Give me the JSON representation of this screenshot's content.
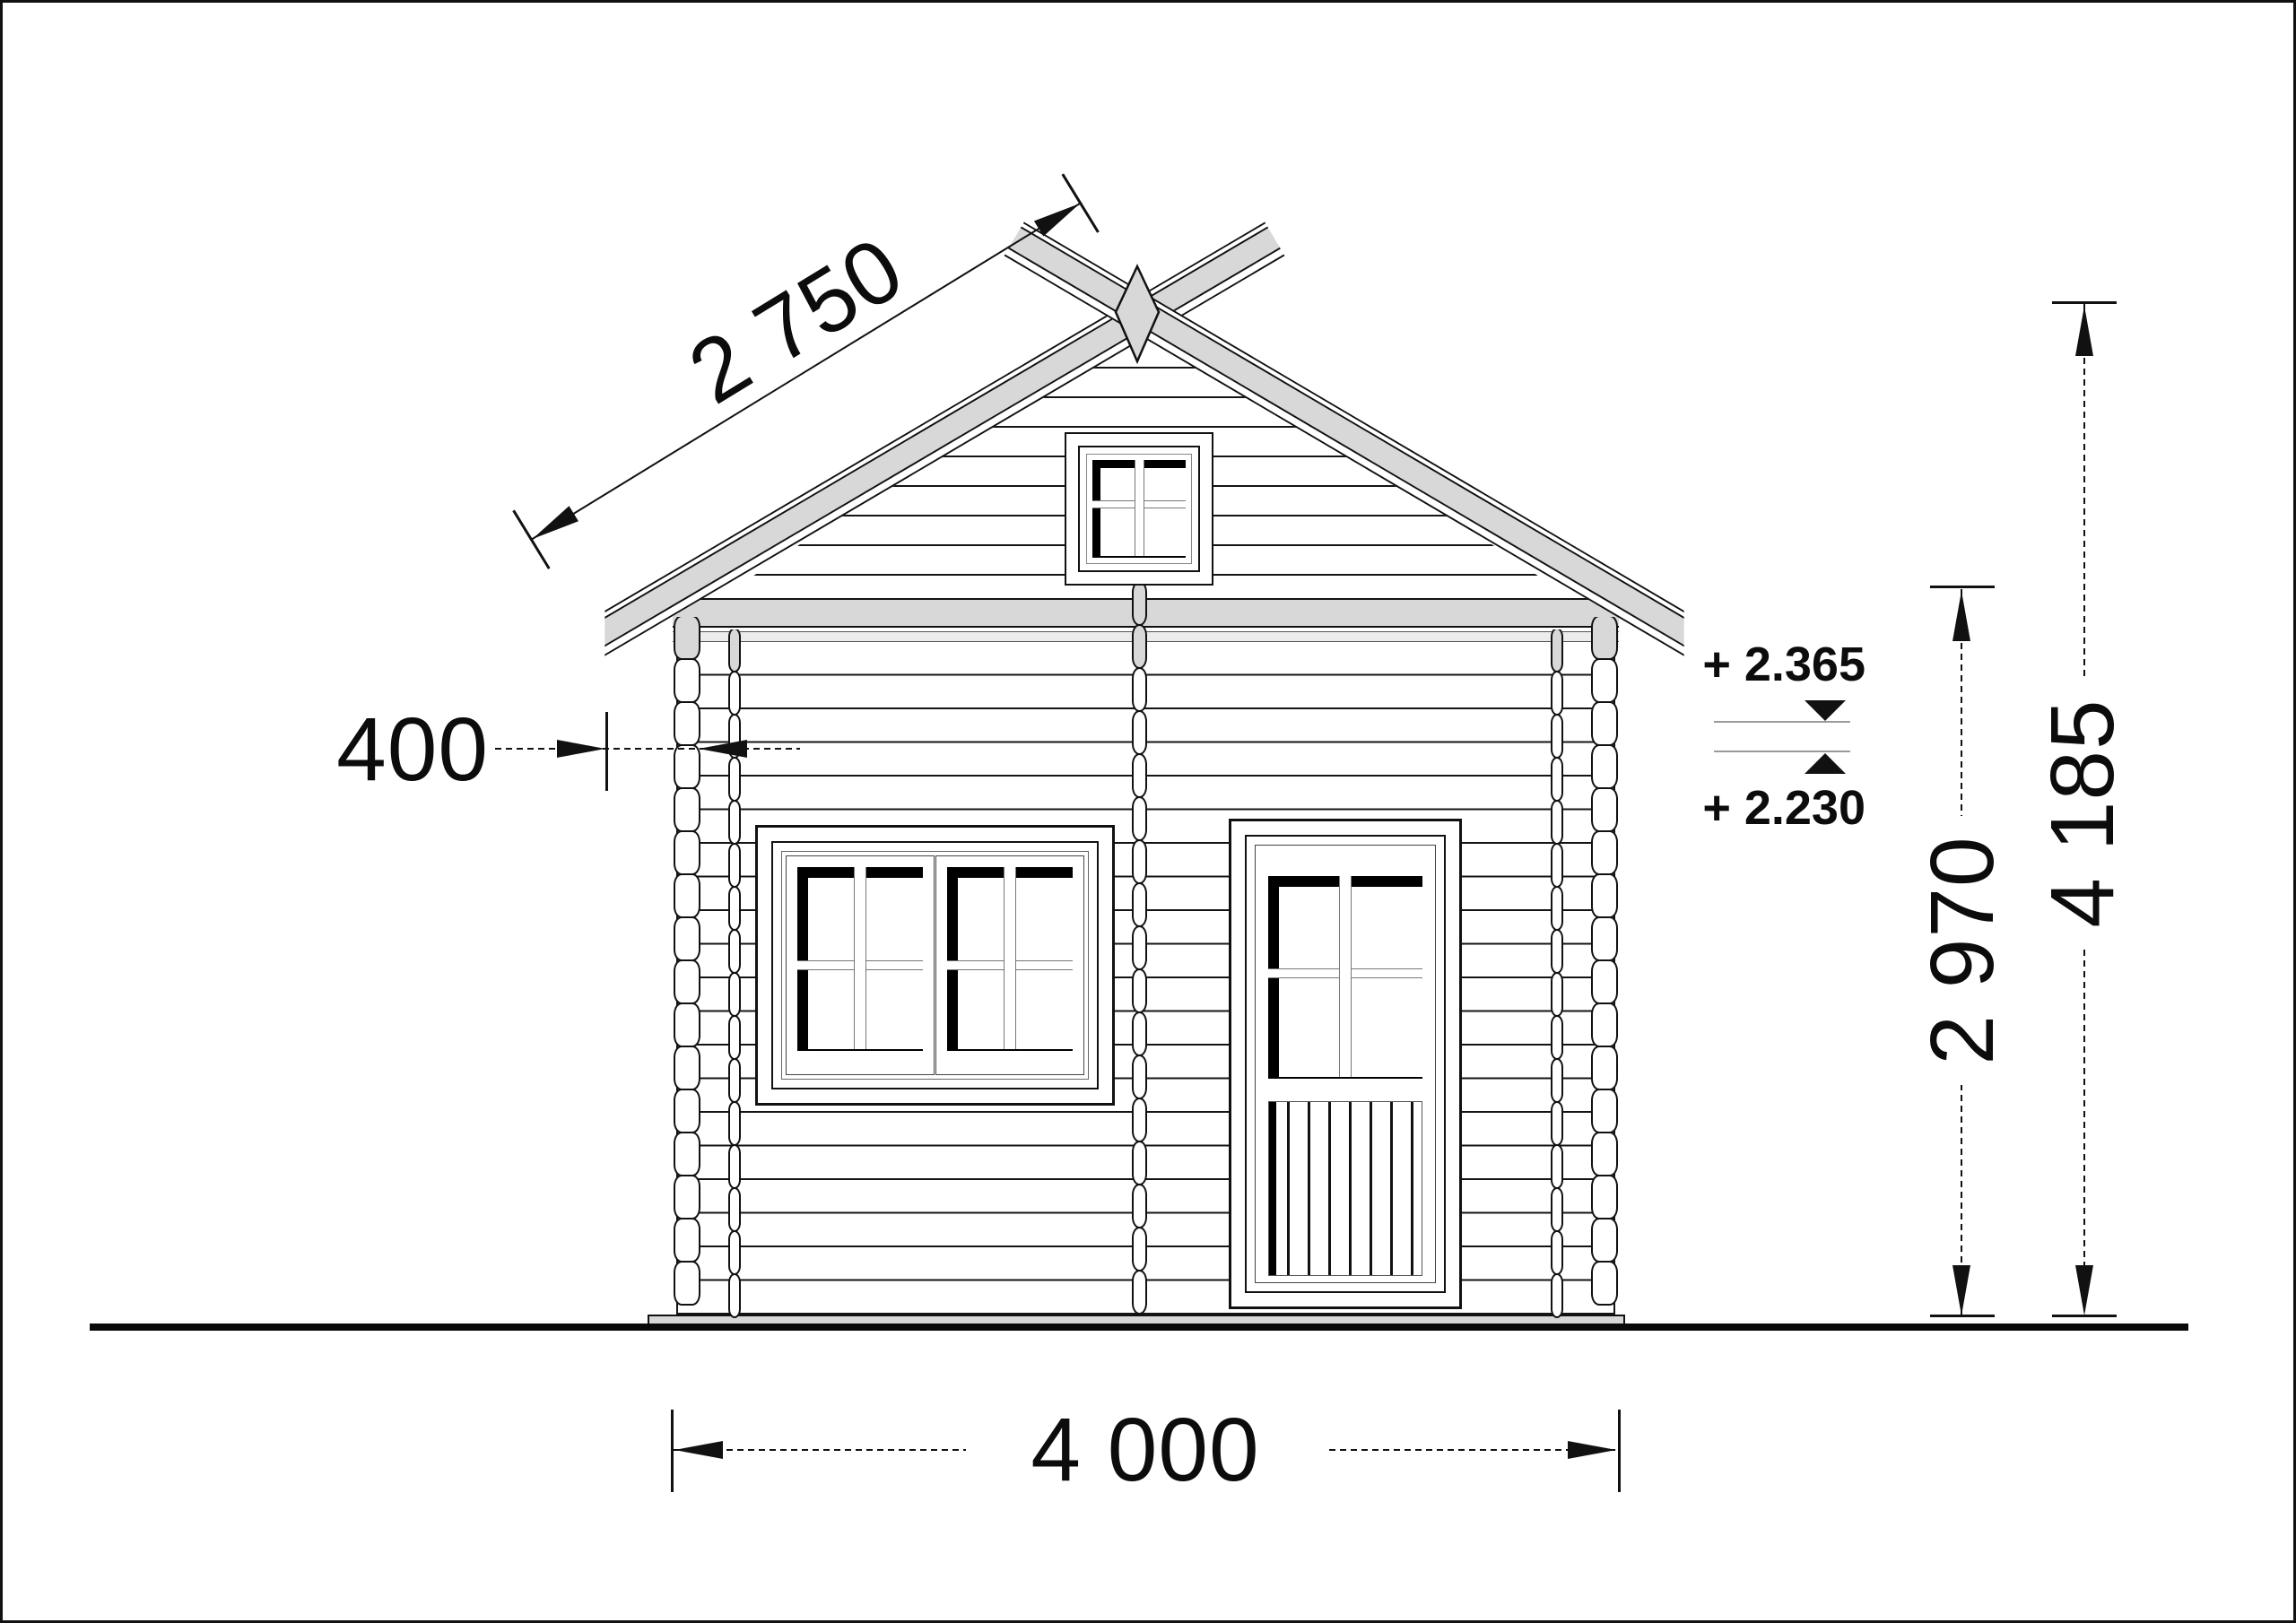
{
  "drawing": {
    "type": "log-cabin-front-elevation",
    "colors": {
      "line": "#111111",
      "roof_fill": "#d8d8d8",
      "beam_fill": "#ececec",
      "marker_line": "#9a9a9a",
      "background": "#ffffff"
    },
    "dimensions": {
      "roof_slope": {
        "value": "2 750"
      },
      "overhang": {
        "value": "400"
      },
      "width": {
        "value": "4 000"
      },
      "wall_height": {
        "value": "2 970"
      },
      "total_height": {
        "value": "4 185"
      }
    },
    "elevation_markers": {
      "upper": {
        "value": "+ 2.365"
      },
      "lower": {
        "value": "+ 2.230"
      }
    }
  }
}
